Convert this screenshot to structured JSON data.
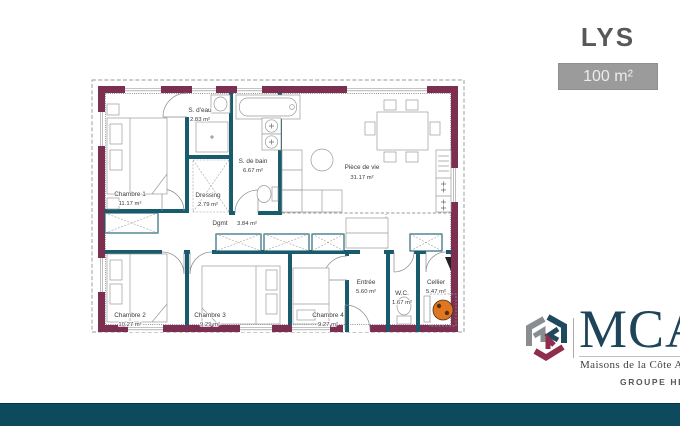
{
  "header": {
    "title": "LYS",
    "area_badge": "100 m²"
  },
  "floor_plan": {
    "rooms": {
      "chambre1": {
        "name": "Chambre 1",
        "area": "11.17 m²"
      },
      "s_deau": {
        "name": "S. d'eau",
        "area": "2.83 m²"
      },
      "dressing": {
        "name": "Dressing",
        "area": "2.79 m²"
      },
      "s_de_bain": {
        "name": "S. de bain",
        "area": "6.67 m²"
      },
      "piece_de_vie": {
        "name": "Pièce de vie",
        "area": "31.17 m²"
      },
      "degagement": {
        "name": "Dgmt",
        "area": "3.84 m²"
      },
      "chambre2": {
        "name": "Chambre 2",
        "area": "10.27 m²"
      },
      "chambre3": {
        "name": "Chambre 3",
        "area": "9.29 m²"
      },
      "chambre4": {
        "name": "Chambre 4",
        "area": "9.27 m²"
      },
      "entree": {
        "name": "Entrée",
        "area": "5.60 m²"
      },
      "wc": {
        "name": "W.C.",
        "area": "1.67 m²"
      },
      "cellier": {
        "name": "Cellier",
        "area": "5.47 m²"
      }
    },
    "colors": {
      "exterior_wall": "#7d2f51",
      "interior_wall": "#175b6d",
      "water_heater": "#e0761f"
    }
  },
  "branding": {
    "brand": "MCA",
    "tagline": "Maisons de la Côte Atlantique",
    "group": "GROUPE HEXAOM"
  },
  "footer": {
    "bar_color": "#0d4a5e"
  }
}
